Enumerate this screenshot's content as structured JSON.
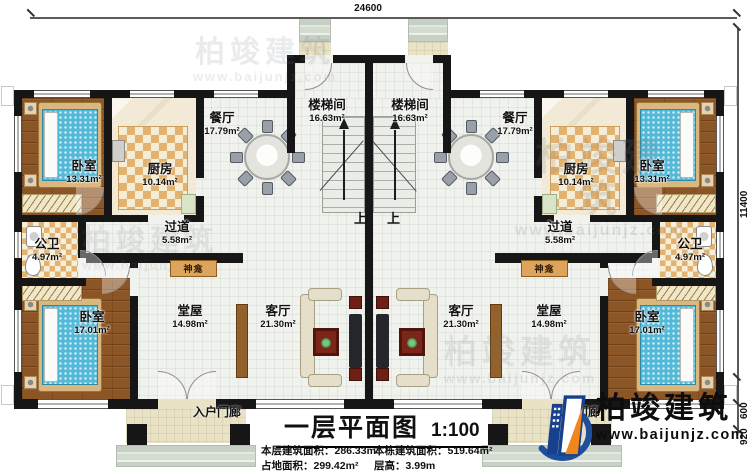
{
  "drawing": {
    "title": "一层平面图",
    "scale": "1:100",
    "stats": [
      {
        "label": "本层建筑面积：",
        "value": "286.33m²"
      },
      {
        "label": "本栋建筑面积：",
        "value": "519.64m²"
      },
      {
        "label": "占地面积：",
        "value": "299.42m²"
      },
      {
        "label": "层高：",
        "value": "3.99m"
      }
    ]
  },
  "brand": {
    "name": "柏竣建筑",
    "website": "www.baijunjz.com"
  },
  "dimensions": {
    "top": "24600",
    "right": "11400",
    "step": "600",
    "porch": "920"
  },
  "annotations": {
    "up": "上",
    "shrine": "神龛",
    "porch": "入户门廊"
  },
  "rooms": [
    {
      "id": "bedroom-tl",
      "name": "卧室",
      "area": "13.31m²"
    },
    {
      "id": "kitchen-l",
      "name": "厨房",
      "area": "10.14m²"
    },
    {
      "id": "dining-l",
      "name": "餐厅",
      "area": "17.79m²"
    },
    {
      "id": "stair-l",
      "name": "楼梯间",
      "area": "16.63m²"
    },
    {
      "id": "hallway-l",
      "name": "过道",
      "area": "5.58m²"
    },
    {
      "id": "bath-l",
      "name": "公卫",
      "area": "4.97m²"
    },
    {
      "id": "bedroom-bl",
      "name": "卧室",
      "area": "17.01m²"
    },
    {
      "id": "hall-l",
      "name": "堂屋",
      "area": "14.98m²"
    },
    {
      "id": "living-l",
      "name": "客厅",
      "area": "21.30m²"
    },
    {
      "id": "stair-r",
      "name": "楼梯间",
      "area": "16.63m²"
    },
    {
      "id": "dining-r",
      "name": "餐厅",
      "area": "17.79m²"
    },
    {
      "id": "kitchen-r",
      "name": "厨房",
      "area": "10.14m²"
    },
    {
      "id": "bedroom-tr",
      "name": "卧室",
      "area": "13.31m²"
    },
    {
      "id": "hallway-r",
      "name": "过道",
      "area": "5.58m²"
    },
    {
      "id": "bath-r",
      "name": "公卫",
      "area": "4.97m²"
    },
    {
      "id": "living-r",
      "name": "客厅",
      "area": "21.30m²"
    },
    {
      "id": "hall-r",
      "name": "堂屋",
      "area": "14.98m²"
    },
    {
      "id": "bedroom-br",
      "name": "卧室",
      "area": "17.01m²"
    }
  ]
}
